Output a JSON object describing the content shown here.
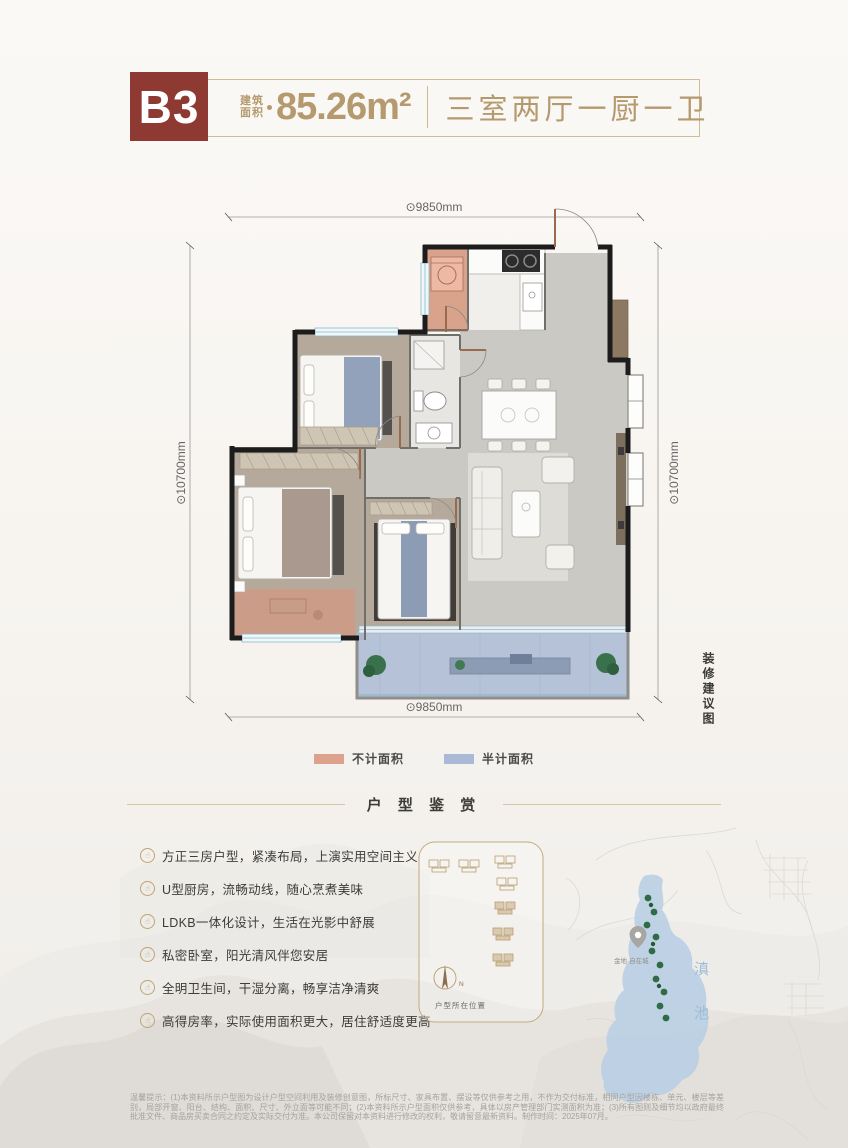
{
  "header": {
    "unit": "B3",
    "area_label_top": "建筑",
    "area_label_bottom": "面积",
    "area_value": "85.26m²",
    "layout": "三室两厅一厨一卫"
  },
  "floorplan": {
    "dims": {
      "top": "⊙9850mm",
      "bottom": "⊙9850mm",
      "left": "⊙10700mm",
      "right": "⊙10700mm"
    },
    "side_note": "装修建议图",
    "legend": [
      {
        "label": "不计面积",
        "color": "#DCA28C"
      },
      {
        "label": "半计面积",
        "color": "#AAB9D6"
      }
    ]
  },
  "section_title": "户 型 鉴 赏",
  "icons": {
    "feature_glyph": "☝"
  },
  "features": [
    "方正三房户型，紧凑布局，上演实用空间主义",
    "U型厨房，流畅动线，随心烹煮美味",
    "LDKB一体化设计，生活在光影中舒展",
    "私密卧室，阳光清风伴您安居",
    "全明卫生间，干湿分离，畅享洁净清爽",
    "高得房率，实际使用面积更大，居住舒适度更高"
  ],
  "siteplan": {
    "label": "户型所在位置",
    "north_label": "N"
  },
  "map": {
    "lake_name_chars": [
      "滇",
      "池"
    ],
    "pin_label": "金地·自在城"
  },
  "disclaimer": "温馨提示：(1)本资料所示户型图为设计户型空间利用及装修创意图，所标尺寸、家具布置、摆设等仅供参考之用，不作为交付标准，相同户型因楼栋、单元、楼层等差别，局部开窗、阳台、结构、面积、尺寸、外立面等可能不同；(2)本资料所示户型面积仅供参考，具体以房产管理部门实测面积为准；(3)所有图则及细节均以政府最终批准文件、商品房买卖合同之约定及实际交付为准。本公司保留对本资料进行修改的权利，敬请留意最新资料。制作时间：2025年07月。",
  "colors": {
    "accent_red": "#8E3A33",
    "gold": "#B49A6E",
    "uncounted_salmon": "#DCA28C",
    "half_counted_blue": "#AAB9D6",
    "lake_blue": "#B9CFE4"
  }
}
